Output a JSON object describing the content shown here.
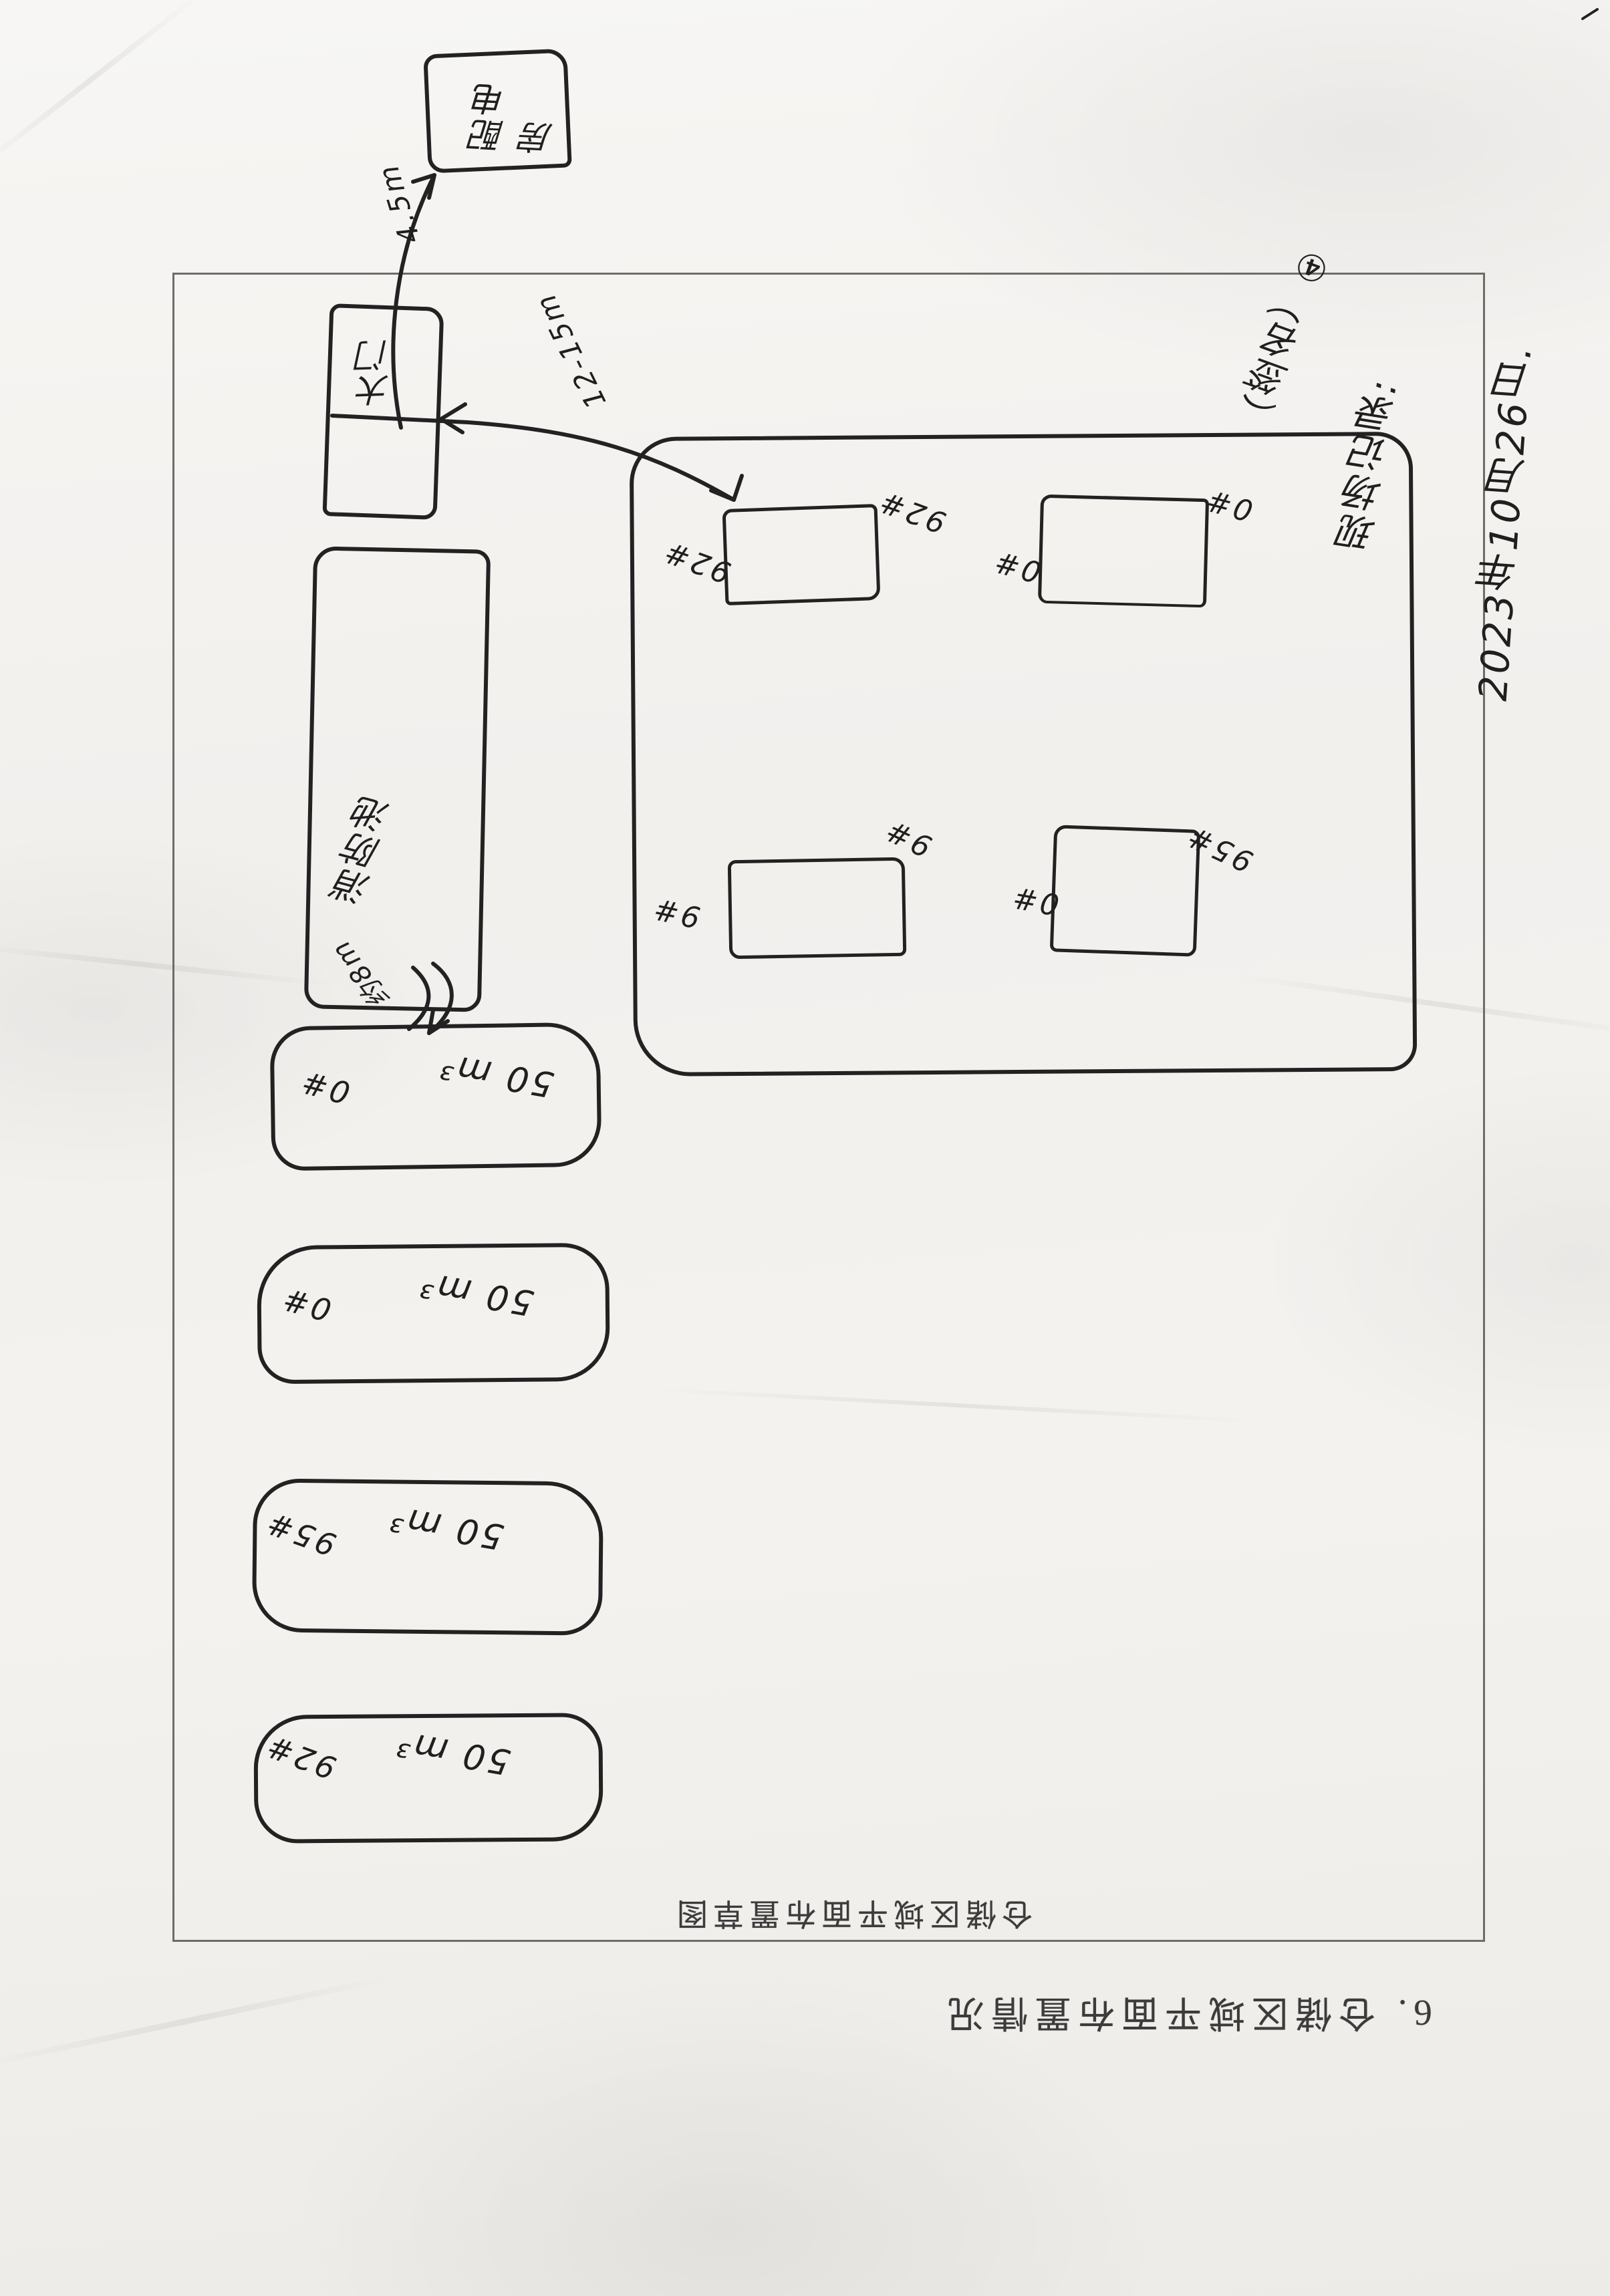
{
  "document": {
    "title": "6. 仓储区域平面布置情况",
    "sketch_caption": "仓储区域平面布置草图"
  },
  "handwritten_annotations": {
    "date_line": "2023年10月26日.",
    "note_line": "现场记录:",
    "signature_line": "（签名）④"
  },
  "outside_box": {
    "label": "配电房"
  },
  "gate_box": {
    "label": "大门"
  },
  "pond_box": {
    "label": "消防池"
  },
  "distance_labels": {
    "frame_to_outside_box": "4.5m",
    "tanks_to_gate": "12-15m",
    "pond_to_tank": "约8m"
  },
  "storage_area": {
    "inner_boxes": [
      {
        "id": "top-left",
        "left_label": "92#",
        "right_label": "92#"
      },
      {
        "id": "top-right",
        "left_label": "0#",
        "right_label": "0#"
      },
      {
        "id": "bottom-left",
        "left_label": "9#",
        "right_label": "9#"
      },
      {
        "id": "bottom-right",
        "left_label": "0#",
        "right_label": "95#"
      }
    ]
  },
  "tanks": [
    {
      "label": "0#",
      "volume": "50 m³"
    },
    {
      "label": "0#",
      "volume": "50 m³"
    },
    {
      "label": "95#",
      "volume": "50 m³"
    },
    {
      "label": "92#",
      "volume": "50 m³"
    }
  ],
  "colors": {
    "paper": "#f2f0ed",
    "ink": "#1f1f1f",
    "print_gray": "#3b3b3b"
  }
}
